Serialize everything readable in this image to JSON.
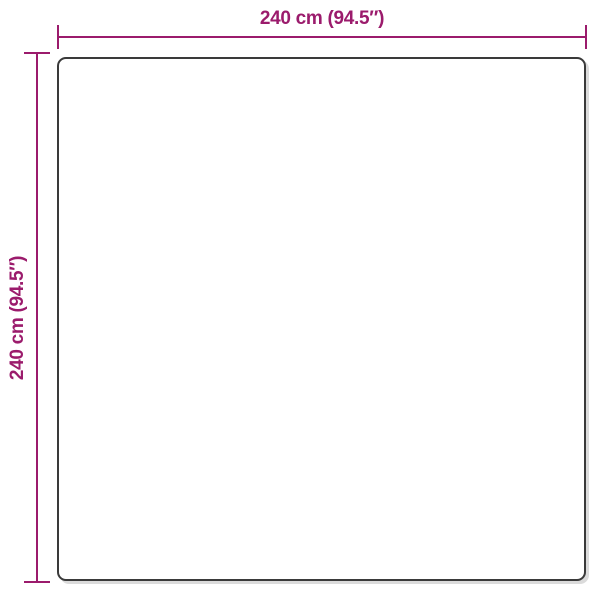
{
  "diagram": {
    "type": "product-dimension-diagram",
    "width_dimension": {
      "label": "240 cm (94.5″)"
    },
    "height_dimension": {
      "label": "240 cm (94.5″)"
    },
    "colors": {
      "accent": "#9B1B6C",
      "outline": "#3A3A3A",
      "bg": "#FFFFFF",
      "shadow": "#DBDBDB"
    }
  }
}
